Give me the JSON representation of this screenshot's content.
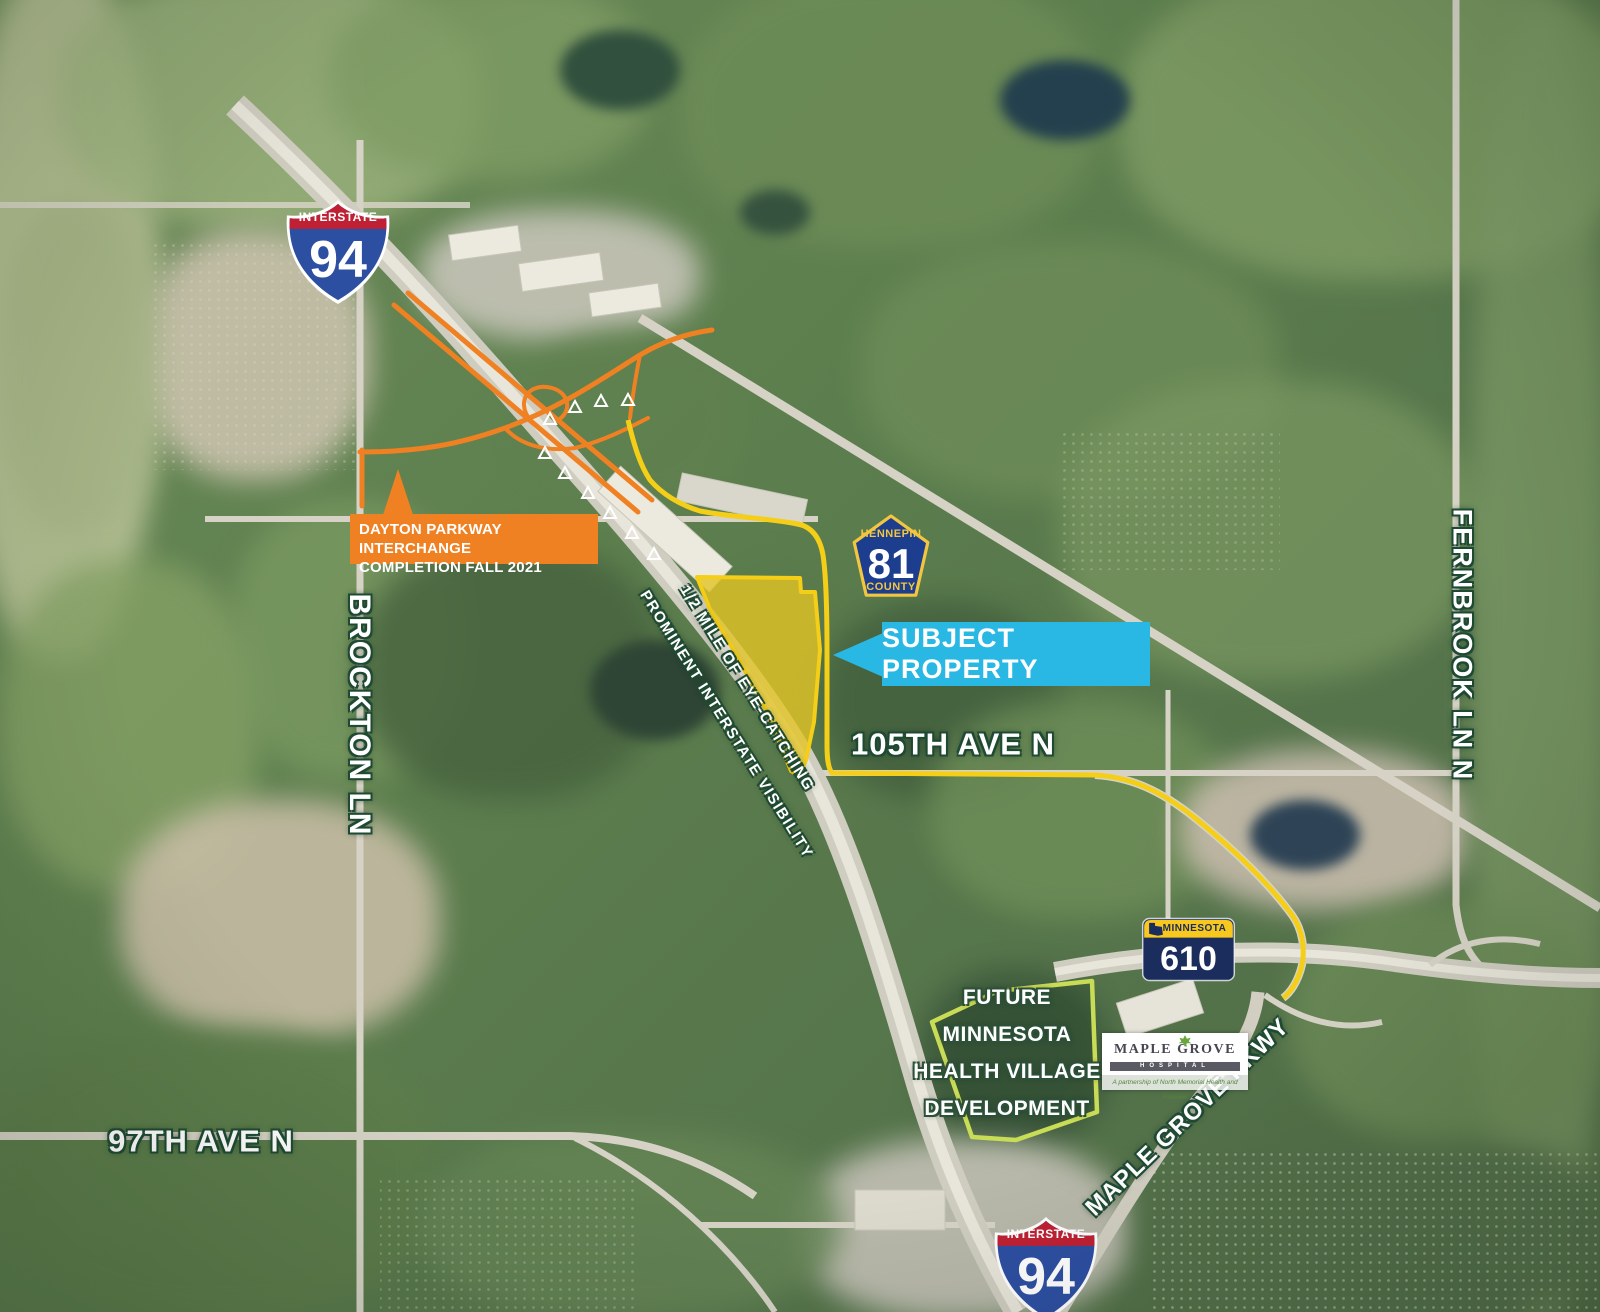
{
  "shields": {
    "interstate_top": {
      "band": "INTERSTATE",
      "number": "94"
    },
    "interstate_bottom": {
      "band": "INTERSTATE",
      "number": "94"
    },
    "county": {
      "top": "HENNEPIN",
      "number": "81",
      "bottom": "COUNTY"
    },
    "state": {
      "band": "MINNESOTA",
      "number": "610"
    }
  },
  "callouts": {
    "interchange": {
      "line1": "DAYTON PARKWAY INTERCHANGE",
      "line2": "COMPLETION FALL 2021"
    },
    "subject_property": {
      "label": "SUBJECT PROPERTY"
    }
  },
  "road_labels": {
    "ave_105": "105TH AVE N",
    "ave_97": "97TH AVE N",
    "brockton": "BROCKTON LN",
    "fernbrook": "FERNBROOK LN N",
    "maple_grove_pkwy": "MAPLE GROVE PKWY"
  },
  "annotations": {
    "visibility_line1": "1/2 MILE OF EYE-CATCHING",
    "visibility_line2": "PROMINENT INTERSTATE VISIBILITY",
    "development_lines": [
      "FUTURE",
      "MINNESOTA",
      "HEALTH VILLAGE",
      "DEVELOPMENT"
    ]
  },
  "hospital_logo": {
    "name": "MAPLE GROVE",
    "sub": "HOSPITAL",
    "tagline": "A partnership of North Memorial Health and Fairview"
  },
  "colors": {
    "subject_callout_cyan": "#29B8E3",
    "interchange_orange": "#F08122",
    "parcel_outline_yellow": "#F5CE18",
    "development_outline_green": "#C9DC55",
    "interstate_red": "#BF2033",
    "interstate_blue": "#2D4FA2",
    "county_blue": "#1D3E8F",
    "county_gold": "#F2C63F",
    "state_navy": "#1A2D5C",
    "state_yellow": "#F8C81E",
    "label_halo_green": "#1E4A33"
  }
}
